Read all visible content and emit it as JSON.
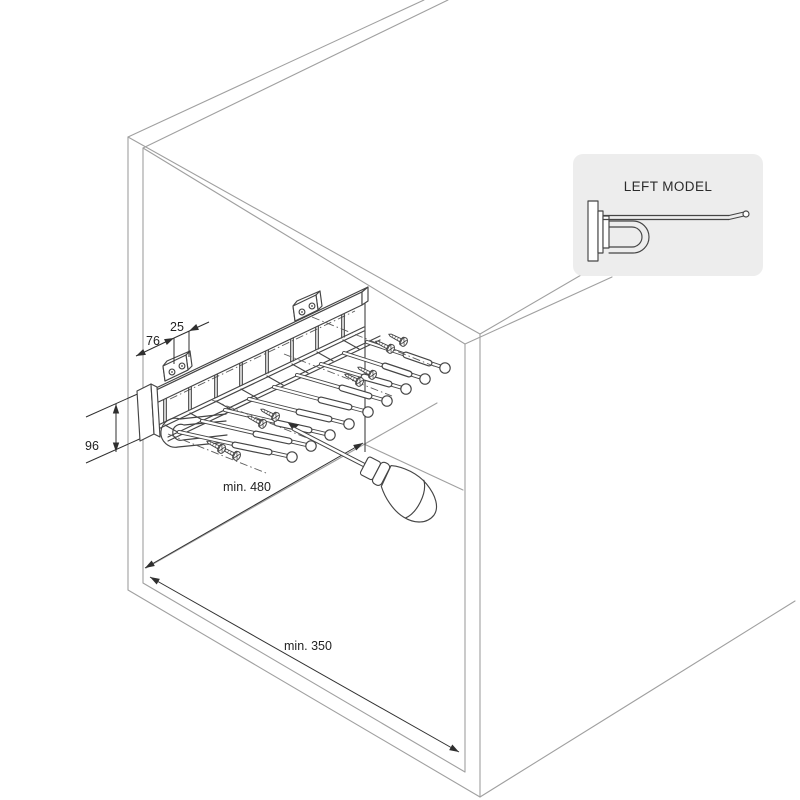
{
  "title": "Pull-out trouser rack installation drawing",
  "inset": {
    "label": "LEFT MODEL"
  },
  "dimensions": {
    "bracket_offset": "76",
    "hole_pitch": "25",
    "plate_height": "96",
    "min_depth": "min. 480",
    "min_width": "min. 350"
  },
  "colors": {
    "background": "#ffffff",
    "cabinet_line": "#a0a0a0",
    "part_line": "#454545",
    "dimension_line": "#2f2f2f",
    "inset_background": "#ededed"
  }
}
